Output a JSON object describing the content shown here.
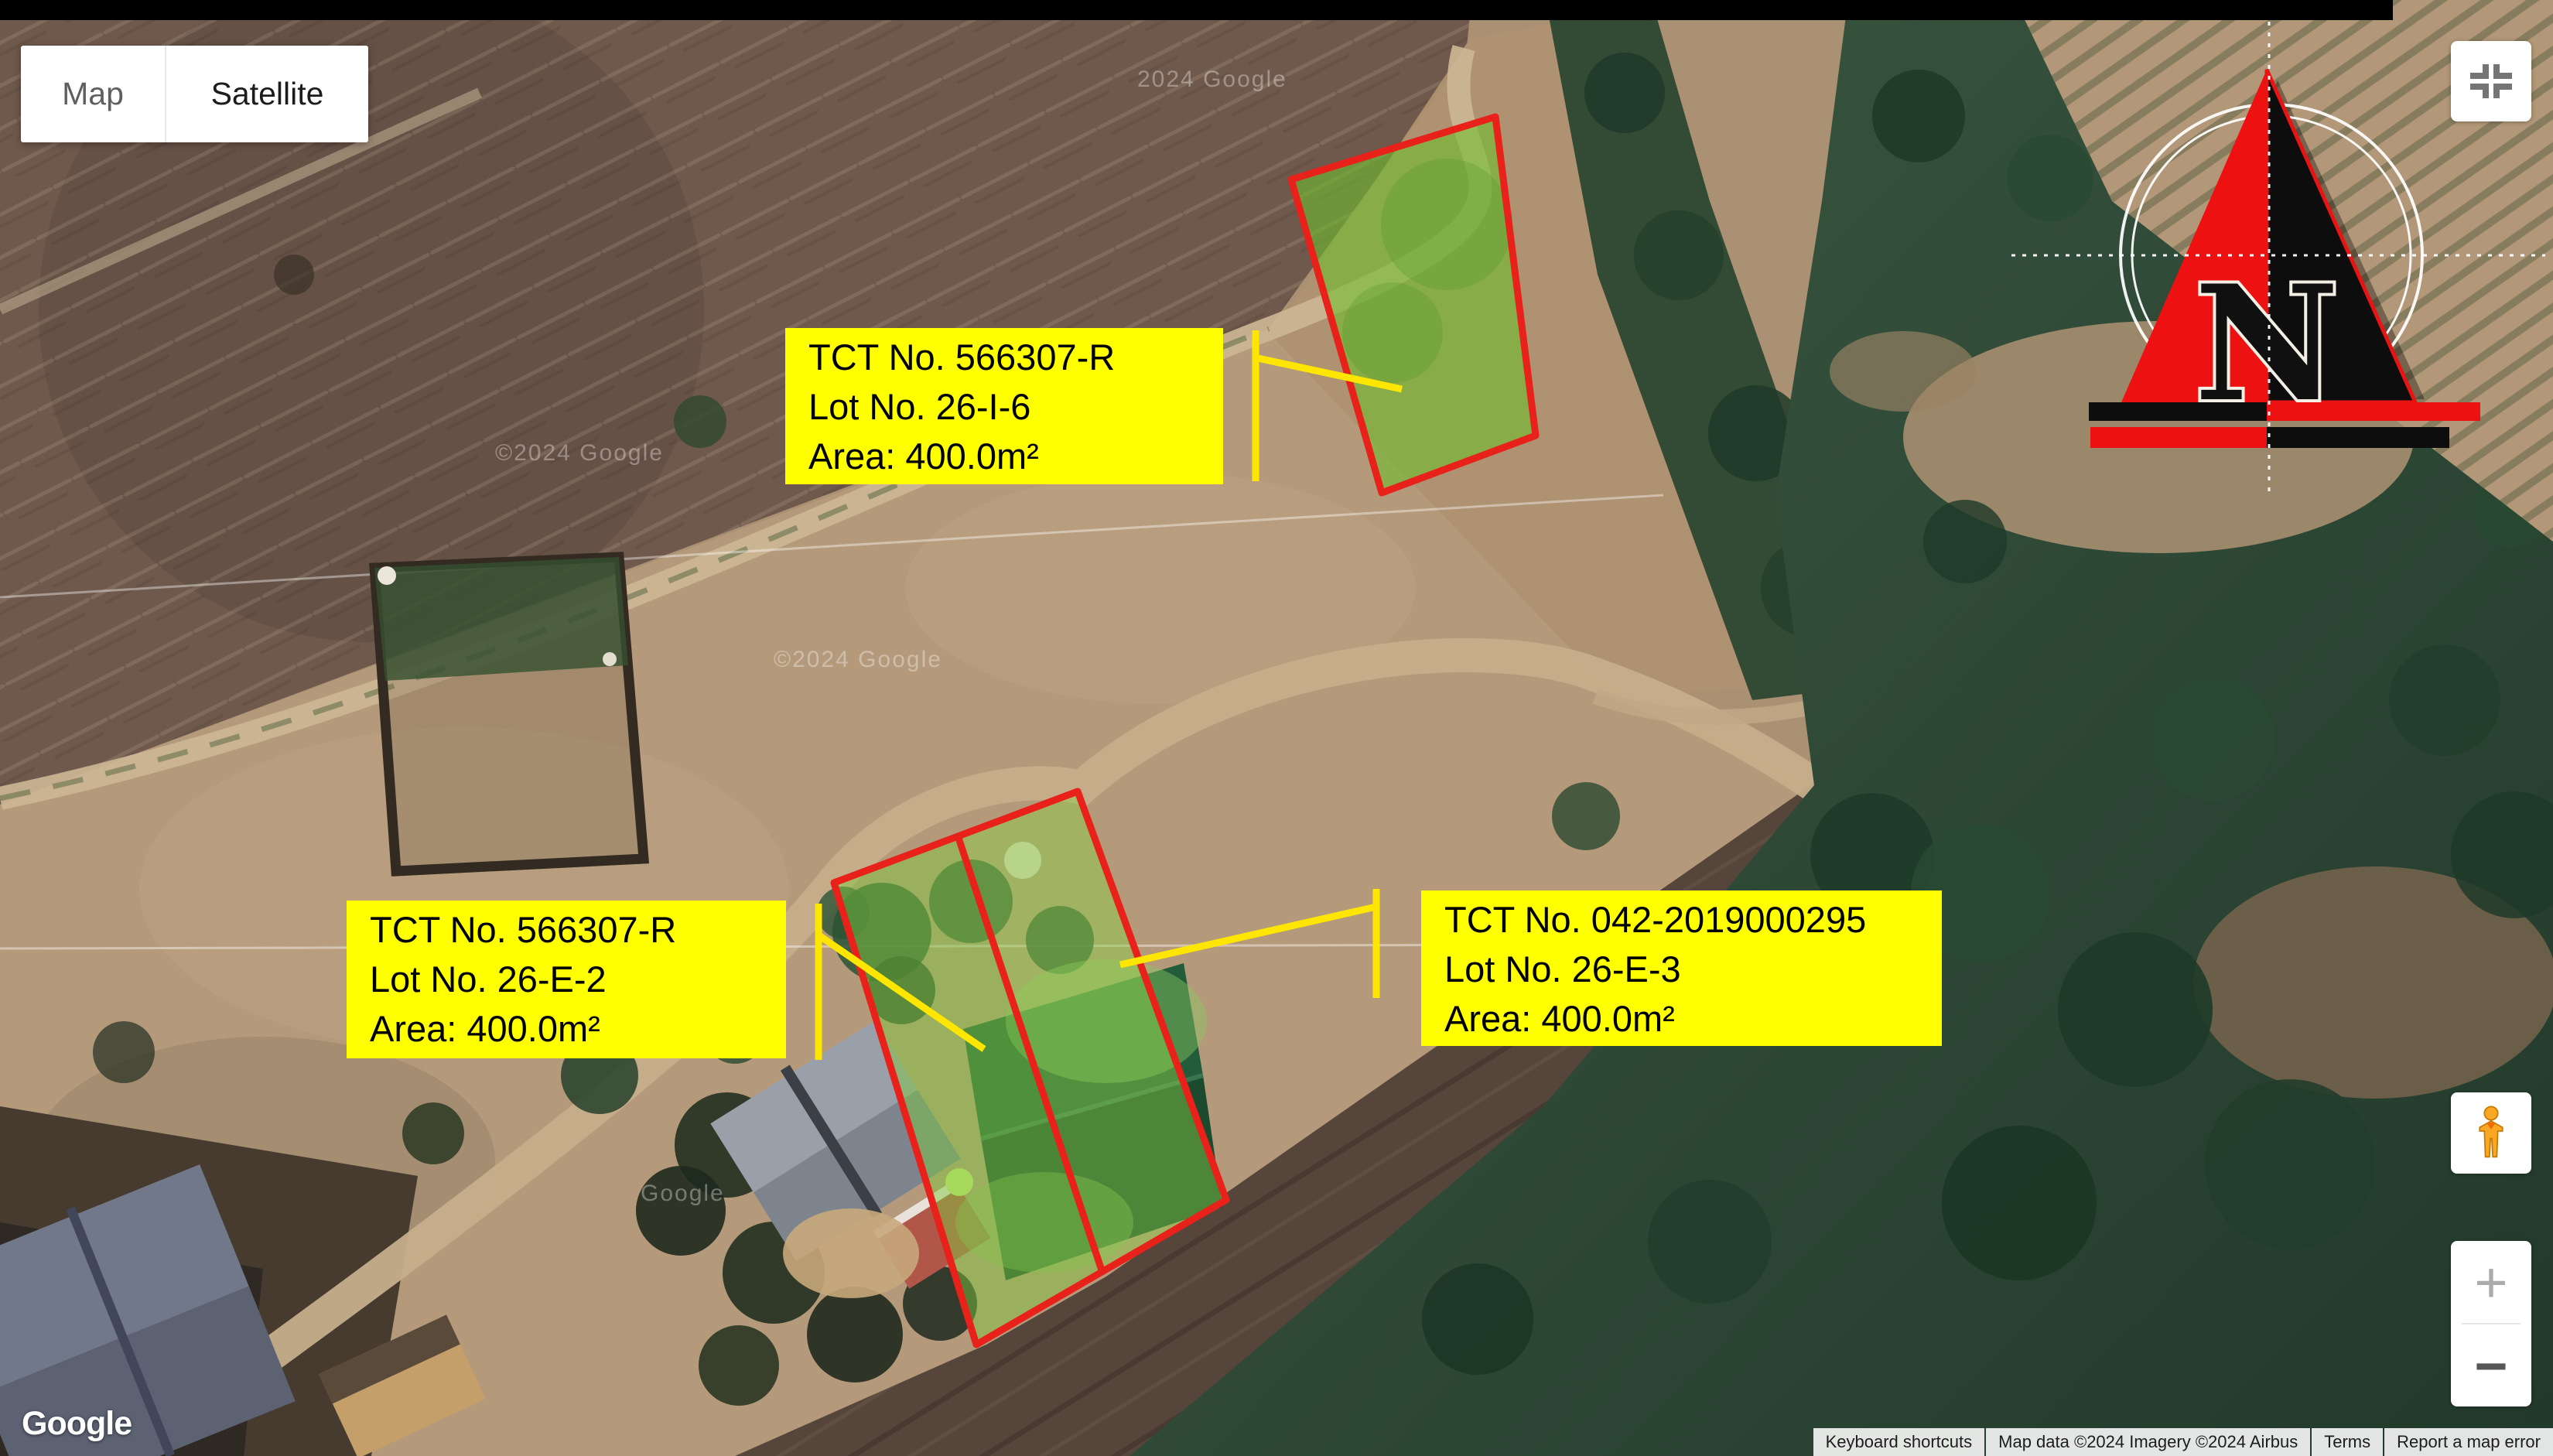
{
  "map_type_control": {
    "map_label": "Map",
    "satellite_label": "Satellite"
  },
  "lot_labels": [
    {
      "tct": "TCT No. 566307-R",
      "lot": "Lot No. 26-I-6",
      "area": "Area: 400.0m²"
    },
    {
      "tct": "TCT No. 566307-R",
      "lot": "Lot No. 26-E-2",
      "area": "Area: 400.0m²"
    },
    {
      "tct": "TCT No. 042-2019000295",
      "lot": "Lot No. 26-E-3",
      "area": "Area: 400.0m²"
    }
  ],
  "compass": {
    "north_label": "N"
  },
  "zoom_control": {
    "zoom_in": "+",
    "zoom_out": "−"
  },
  "google_logo": "Google",
  "watermarks": [
    "2024 Google",
    "©2024 Google",
    "Google",
    "©2024 Google"
  ],
  "attribution": {
    "items": [
      "Keyboard shortcuts",
      "Map data ©2024 Imagery ©2024 Airbus",
      "Terms",
      "Report a map error"
    ]
  },
  "colors": {
    "label_bg": "#ffff00",
    "lot_outline": "#e8211a",
    "lot_fill_green": "#7ec83c",
    "leader_yellow": "#ffe600",
    "compass_red": "#ee1111",
    "compass_black": "#0d0d0d"
  }
}
